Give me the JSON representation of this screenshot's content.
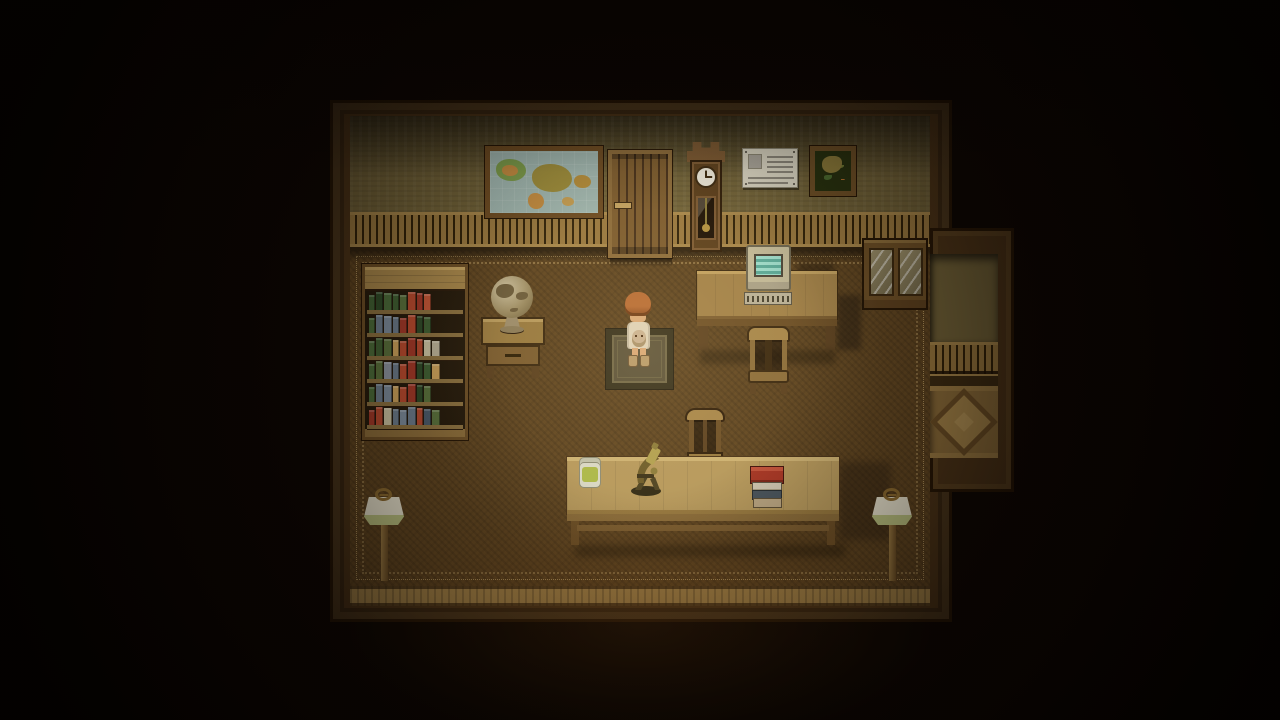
{
  "palette": {
    "bg": "#0a0502",
    "trim": "#4a3318",
    "trim_dark": "#241505",
    "trim_light": "#6b4e26",
    "wall": "#6f6138",
    "wainscot": "#96763e",
    "wainscot_gap": "#2e2008",
    "rail": "#a5854a",
    "carpet": "#5f4521",
    "lace": "#d8b878",
    "bottomwall": "#a5854a",
    "wood_light": "#b5985c",
    "shelf_bg": "#241a0c",
    "map_sea": "#9db4ae",
    "screen": "#7cc8b4",
    "plaque_bg": "#d8d4c2",
    "plaque_ink": "#8a867a",
    "skin": "#d8a878",
    "hair": "#a85f2e",
    "hair_dark": "#6e3a16",
    "shirt": "#ded4bc",
    "plush": "#c8b294",
    "boots": "#b5996b",
    "jar_green": "#aab848",
    "brass": "#8a7a3a",
    "red": "#a83424",
    "page": "#d0c8b4",
    "slate": "#46525c",
    "rug": "#57503a",
    "rug_border": "#322e1c",
    "parquet": "#8a6c3a",
    "parquet_light": "#b59558"
  },
  "labels": {
    "world_map": "framed world map",
    "door": "wooden door",
    "clock": "grandfather clock",
    "plaque": "pinned certificate with photo",
    "painting": "framed flower painting",
    "cabinet": "glass-front cabinet",
    "computer": "computer monitor with teal screen",
    "keyboard": "computer keyboard",
    "computer_desk": "computer desk",
    "computer_chair": "wooden chair at computer desk",
    "bookshelf": "bookshelf full of books",
    "globe": "desktop globe",
    "side_table": "side table with drawer",
    "player": "child character holding plush toy",
    "rug": "small dark rug",
    "long_desk": "long work desk",
    "jar": "jar with green contents",
    "microscope": "brass microscope",
    "book_stack": "stack of books",
    "reading_chair": "chair behind long desk",
    "lamp_left": "floor lamp",
    "lamp_right": "floor lamp",
    "alcove": "parquet-floor alcove"
  },
  "bookshelf": {
    "shelves": [
      [
        "#3f5f33",
        "#2e4a28",
        "#4a6b3a",
        "#3f5f33",
        "#58703c",
        "#b5492e",
        "#a03828",
        "#c25636"
      ],
      [
        "#4a6b3a",
        "#6a7a8a",
        "#7a8a9a",
        "#6a7a8a",
        "#a03828",
        "#b5492e",
        "#2e4a28",
        "#3f5f33"
      ],
      [
        "#4a6b3a",
        "#3f5f33",
        "#58703c",
        "#c9a05a",
        "#b5492e",
        "#a03828",
        "#b5492e",
        "#c8c0a0",
        "#b8b098"
      ],
      [
        "#4a6b3a",
        "#58703c",
        "#8a93a0",
        "#6a7a8a",
        "#b5492e",
        "#a03828",
        "#2e4a28",
        "#3f5f33",
        "#c9a05a"
      ],
      [
        "#4a6b3a",
        "#6a7a8a",
        "#7a8a9a",
        "#c9a05a",
        "#b5492e",
        "#a03828",
        "#2e4a28",
        "#58703c"
      ],
      [
        "#a03828",
        "#b5492e",
        "#c8c0a0",
        "#6a7a8a",
        "#7a8a9a",
        "#6a7a8a",
        "#b5492e",
        "#4a5a6a",
        "#58703c"
      ]
    ]
  },
  "plaque": {
    "has_photo": true,
    "right_lines": 4,
    "bottom_lines": 2
  },
  "computer": {
    "screen_lines": 4
  }
}
